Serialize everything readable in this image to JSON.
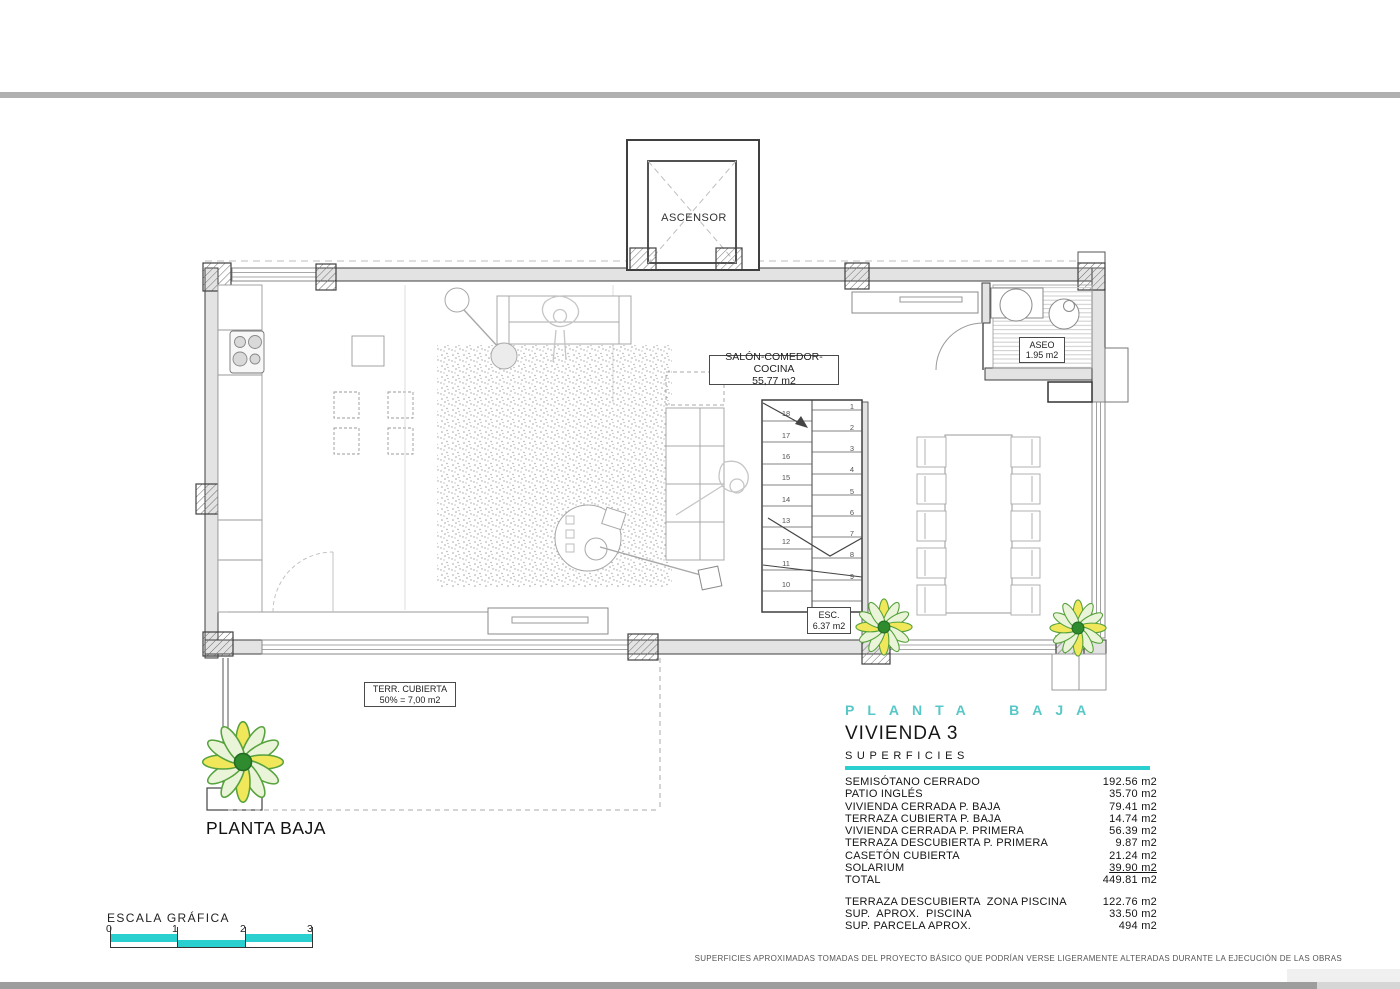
{
  "plan": {
    "elevator_label": "ASCENSOR",
    "labels": {
      "salon": {
        "line1": "SALÓN-COMEDOR-COCINA",
        "line2": "55,77 m2"
      },
      "aseo": {
        "line1": "ASEO",
        "line2": "1.95 m2"
      },
      "esc": {
        "line1": "ESC.",
        "line2": "6.37 m2"
      },
      "terraza": {
        "line1": "TERR. CUBIERTA",
        "line2": "50% = 7,00 m2"
      }
    },
    "floor_name": "PLANTA BAJA",
    "stairs": {
      "left_numbers": [
        "18",
        "17",
        "16",
        "15",
        "14",
        "13",
        "12",
        "11",
        "10"
      ],
      "right_numbers": [
        "1",
        "2",
        "3",
        "4",
        "5",
        "6",
        "7",
        "8",
        "9"
      ]
    }
  },
  "info": {
    "floor_title": "PLANTA BAJA",
    "unit_title": "VIVIENDA 3",
    "section_title": "SUPERFICIES",
    "accent_color": "#2ad0d0",
    "rows": [
      {
        "label": "SEMISÓTANO CERRADO",
        "value": "192.56 m2"
      },
      {
        "label": "PATIO INGLÉS",
        "value": "35.70 m2"
      },
      {
        "label": "VIVIENDA CERRADA P. BAJA",
        "value": "79.41 m2"
      },
      {
        "label": "TERRAZA CUBIERTA P. BAJA",
        "value": "14.74 m2"
      },
      {
        "label": "VIVIENDA CERRADA P. PRIMERA",
        "value": "56.39 m2"
      },
      {
        "label": "TERRAZA DESCUBIERTA P. PRIMERA",
        "value": "9.87 m2"
      },
      {
        "label": "CASETÓN CUBIERTA",
        "value": "21.24 m2"
      },
      {
        "label": "SOLARIUM",
        "value": "39.90 m2"
      },
      {
        "label": "TOTAL",
        "value": "449.81 m2"
      }
    ],
    "extra_rows": [
      {
        "label": "TERRAZA DESCUBIERTA  ZONA PISCINA",
        "value": "122.76 m2"
      },
      {
        "label": "SUP.  APROX.  PISCINA",
        "value": "33.50 m2"
      },
      {
        "label": "SUP. PARCELA APROX.",
        "value": "494 m2"
      }
    ]
  },
  "scale": {
    "title": "ESCALA GRÁFICA",
    "ticks": [
      "0",
      "1",
      "2",
      "3"
    ],
    "bar_color": "#2ad0d0"
  },
  "footer": {
    "disclaimer": "SUPERFICIES APROXIMADAS TOMADAS DEL PROYECTO BÁSICO QUE PODRÍAN VERSE LIGERAMENTE ALTERADAS DURANTE LA EJECUCIÓN DE LAS OBRAS"
  }
}
